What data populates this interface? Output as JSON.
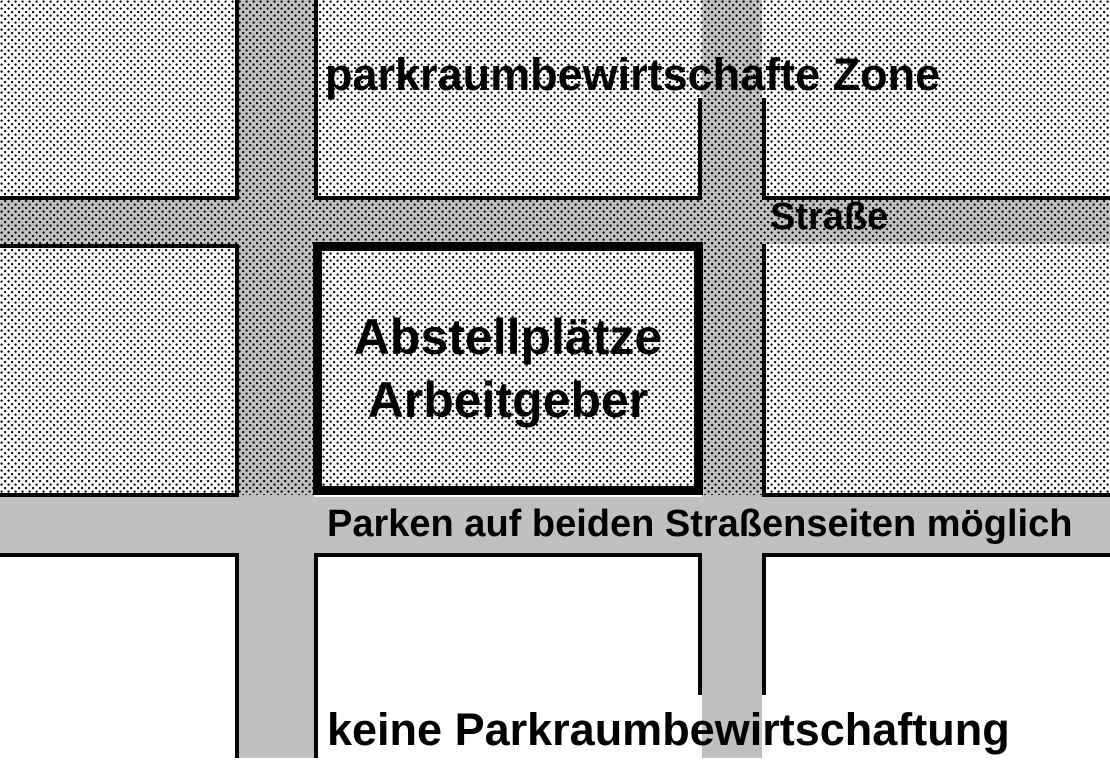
{
  "colors": {
    "street": "#c0c0c0",
    "line": "#000000",
    "background": "#ffffff"
  },
  "diagram": {
    "zone_label": "parkraumbewirtschafte Zone",
    "street_name": "Straße",
    "central_block": {
      "line1": "Abstellplätze",
      "line2": "Arbeitgeber"
    },
    "bottom_street_label": "Parken auf beiden Straßenseiten möglich",
    "bottom_zone_label": "keine Parkraumbewirtschaftung"
  }
}
